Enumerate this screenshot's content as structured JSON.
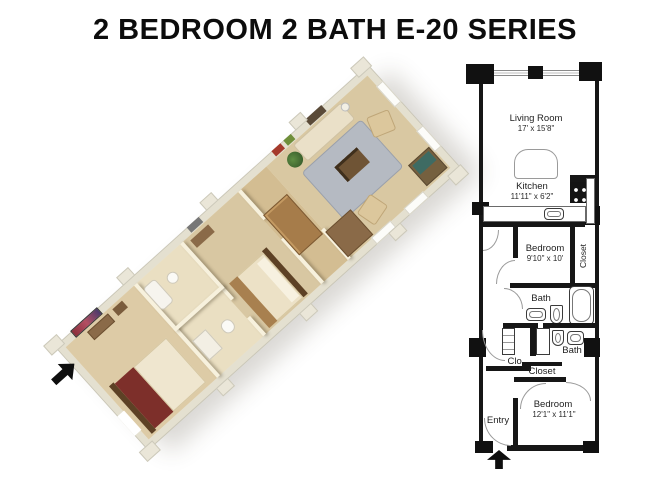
{
  "title": "2 BEDROOM 2 BATH E-20 SERIES",
  "plan": {
    "living_room": {
      "label": "Living Room",
      "dims": "17' x 15'8\""
    },
    "kitchen": {
      "label": "Kitchen",
      "dims": "11'11\" x 6'2\""
    },
    "bedroom1": {
      "label": "Bedroom",
      "dims": "9'10\" x 10'"
    },
    "closet1": {
      "label": "Closet"
    },
    "bath1": {
      "label": "Bath"
    },
    "bath2": {
      "label": "Bath"
    },
    "clo": {
      "label": "Clo."
    },
    "closet2": {
      "label": "Closet"
    },
    "entry": {
      "label": "Entry"
    },
    "bedroom2": {
      "label": "Bedroom",
      "dims": "12'1\" x 11'1\""
    }
  },
  "colors": {
    "plan_wall": "#161616",
    "model_wall_outer": "#e4e0d0",
    "model_wall_inner": "#f7f1dd",
    "model_carpet": "#d9c8a2",
    "bed_blanket": "#7d2f2a",
    "rug": "#b5bac2",
    "wood_furniture": "#8a6a48"
  }
}
